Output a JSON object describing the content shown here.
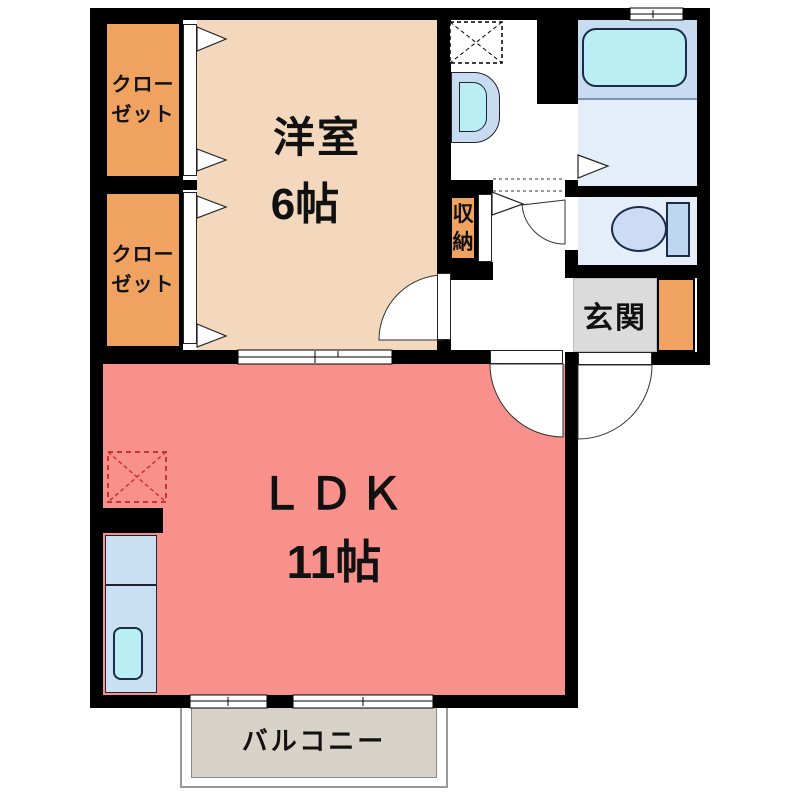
{
  "plan_title": "1LDK floor plan",
  "rooms": {
    "closet1": {
      "label": "クロー\nゼット"
    },
    "closet2": {
      "label": "クロー\nゼット"
    },
    "western": {
      "name": "洋室",
      "size": "6帖"
    },
    "storage": {
      "label": "収\n納"
    },
    "entrance": {
      "label": "玄関"
    },
    "ldk": {
      "name": "ＬＤＫ",
      "size": "11帖"
    },
    "balcony": {
      "label": "バルコニー"
    }
  },
  "colors": {
    "wall": "#000000",
    "western_room": "#F3D8BD",
    "closet": "#F0A360",
    "ldk": "#F8908C",
    "entrance_floor": "#DBDBDB",
    "shoe_cabinet": "#F0A360",
    "bathroom_floor": "#E3EEF9",
    "bathtub_zone": "#C7DCF0",
    "bathtub": "#B9EEF4",
    "toilet_room": "#E3EEF9",
    "toilet_bowl": "#CCDCF4",
    "toilet_tank": "#BDD7EE",
    "washbasin": "#C7DCF0",
    "washbasin_inner": "#B9EEF4",
    "kitchen_counter": "#C9DFF2",
    "sink": "#B9EEF4",
    "balcony_floor": "#D9D2C8",
    "fridge_outline": "#CC3333"
  }
}
